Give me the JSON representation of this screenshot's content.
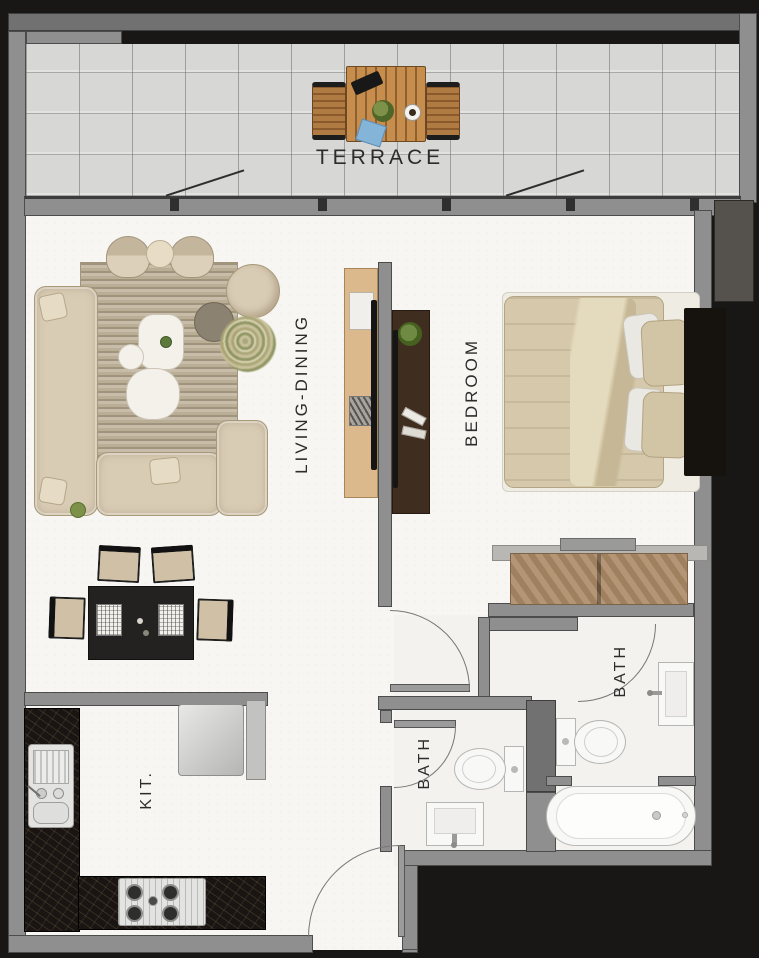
{
  "rooms": {
    "terrace": {
      "label": "TERRACE"
    },
    "living": {
      "label": "LIVING-DINING"
    },
    "bedroom": {
      "label": "BEDROOM"
    },
    "bath_main": {
      "label": "BATH"
    },
    "bath_small": {
      "label": "BATH"
    },
    "kitchen": {
      "label": "KIT."
    }
  },
  "colors": {
    "background": "#191715",
    "wall": "#8f8f8f",
    "wall_outline": "#4c4c4c",
    "floor": "#f7f6f3",
    "terrace_tile": "#d7d7d5",
    "upholstery_beige": "#d9ccb5",
    "rug": "#bbae96",
    "wood_light": "#dcb98c",
    "wood_terrace": "#c68d4d",
    "wood_dresser": "#ab8a66",
    "wood_dark": "#3f2e20",
    "counter_black": "#1a1512",
    "fixture_white": "#f8f8f6",
    "dining_black": "#242220",
    "napkin_blue": "#85b4d9",
    "plant_green": "#5d7a3c"
  }
}
